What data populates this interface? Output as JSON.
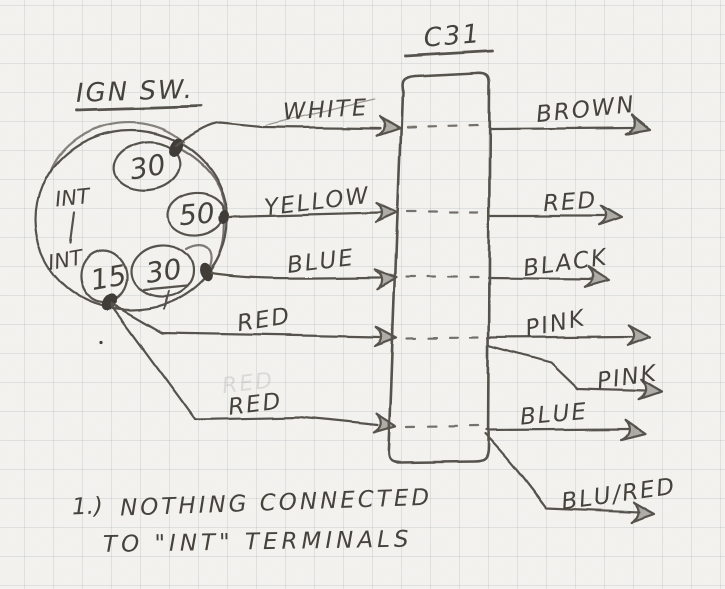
{
  "switch": {
    "title": "IGN SW.",
    "int_top": "INT",
    "int_bottom": "INT",
    "terminals": [
      {
        "label": "30"
      },
      {
        "label": "50"
      },
      {
        "label": "30"
      },
      {
        "label": "15"
      }
    ]
  },
  "connector": {
    "label": "C31"
  },
  "left_wires": [
    {
      "label": "WHITE"
    },
    {
      "label": "YELLOW"
    },
    {
      "label": "BLUE"
    },
    {
      "label": "RED"
    },
    {
      "label": "RED"
    }
  ],
  "erased_label": "RED",
  "right_wires": [
    {
      "label": "BROWN"
    },
    {
      "label": "RED"
    },
    {
      "label": "BLACK"
    },
    {
      "label": "PINK"
    },
    {
      "label": "PINK"
    },
    {
      "label": "BLUE"
    },
    {
      "label": "BLU/RED"
    }
  ],
  "note": {
    "number": "1.)",
    "line1": "NOTHING CONNECTED",
    "line2": "TO \"INT\" TERMINALS"
  },
  "colors": {
    "paper": "#f4f3f0",
    "grid": "#c9ced6",
    "pencil": "#57534d"
  }
}
